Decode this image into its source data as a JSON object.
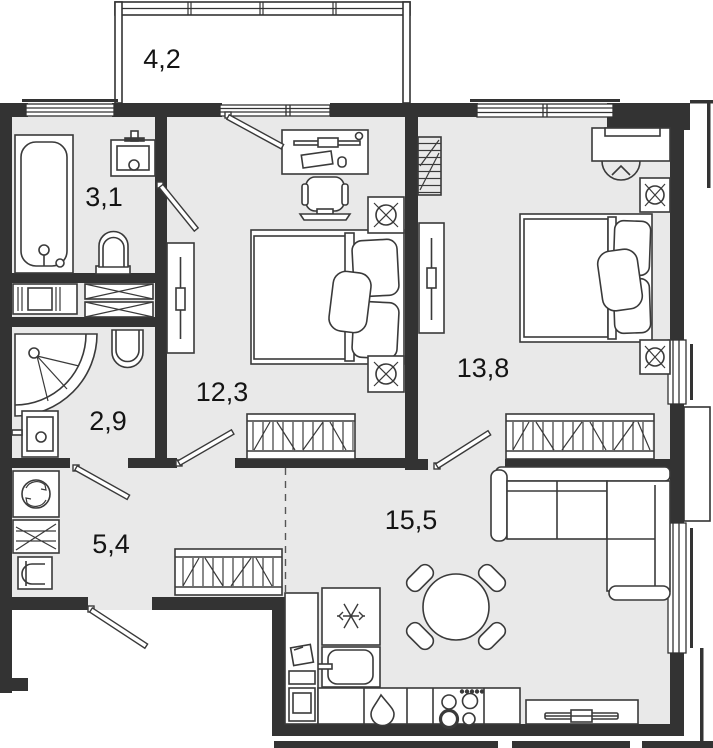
{
  "plan_type": "apartment-floor-plan",
  "rooms": [
    {
      "id": "balcony",
      "label": "4,2"
    },
    {
      "id": "bathroom",
      "label": "3,1"
    },
    {
      "id": "shower-room",
      "label": "2,9"
    },
    {
      "id": "hallway",
      "label": "5,4"
    },
    {
      "id": "bedroom-1",
      "label": "12,3"
    },
    {
      "id": "bedroom-2",
      "label": "13,8"
    },
    {
      "id": "kitchen-living-room",
      "label": "15,5"
    }
  ],
  "colors": {
    "background": "#ffffff",
    "room_fill": "#e9e9e9",
    "wall": "#333333",
    "furniture_line": "#3a3a3a",
    "label_text": "#141414"
  },
  "icons": [
    "bathtub-icon",
    "sink-icon",
    "toilet-icon",
    "shower-icon",
    "ventilation-shaft-icon",
    "washing-machine-icon",
    "shelf-icon",
    "wardrobe-icon",
    "mirror-panel-icon",
    "door-leaf-icon",
    "desk-icon",
    "desk-chair-icon",
    "double-bed-icon",
    "nightstand-lamp-icon",
    "radiator-icon",
    "corner-sofa-icon",
    "dining-table-icon",
    "chair-icon",
    "fridge-snowflake-icon",
    "kitchen-sink-icon",
    "stove-icon",
    "tv-stand-icon",
    "window-icon"
  ]
}
